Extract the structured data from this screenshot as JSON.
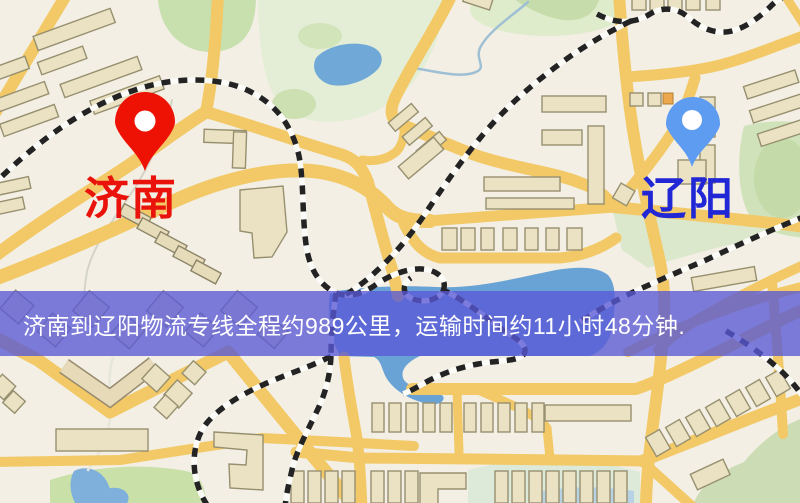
{
  "map": {
    "origin": {
      "name": "济南",
      "label_color": "#e9130b",
      "pin_color": "#ee1205"
    },
    "destination": {
      "name": "辽阳",
      "label_color": "#2127d4",
      "pin_color": "#5e9cf2"
    }
  },
  "banner": {
    "text": "济南到辽阳物流专线全程约989公里，运输时间约11小时48分钟.",
    "background": "rgba(88,88,214,0.78)",
    "text_color": "#ffffff",
    "distance": "989公里",
    "duration": "11小时48分钟"
  }
}
